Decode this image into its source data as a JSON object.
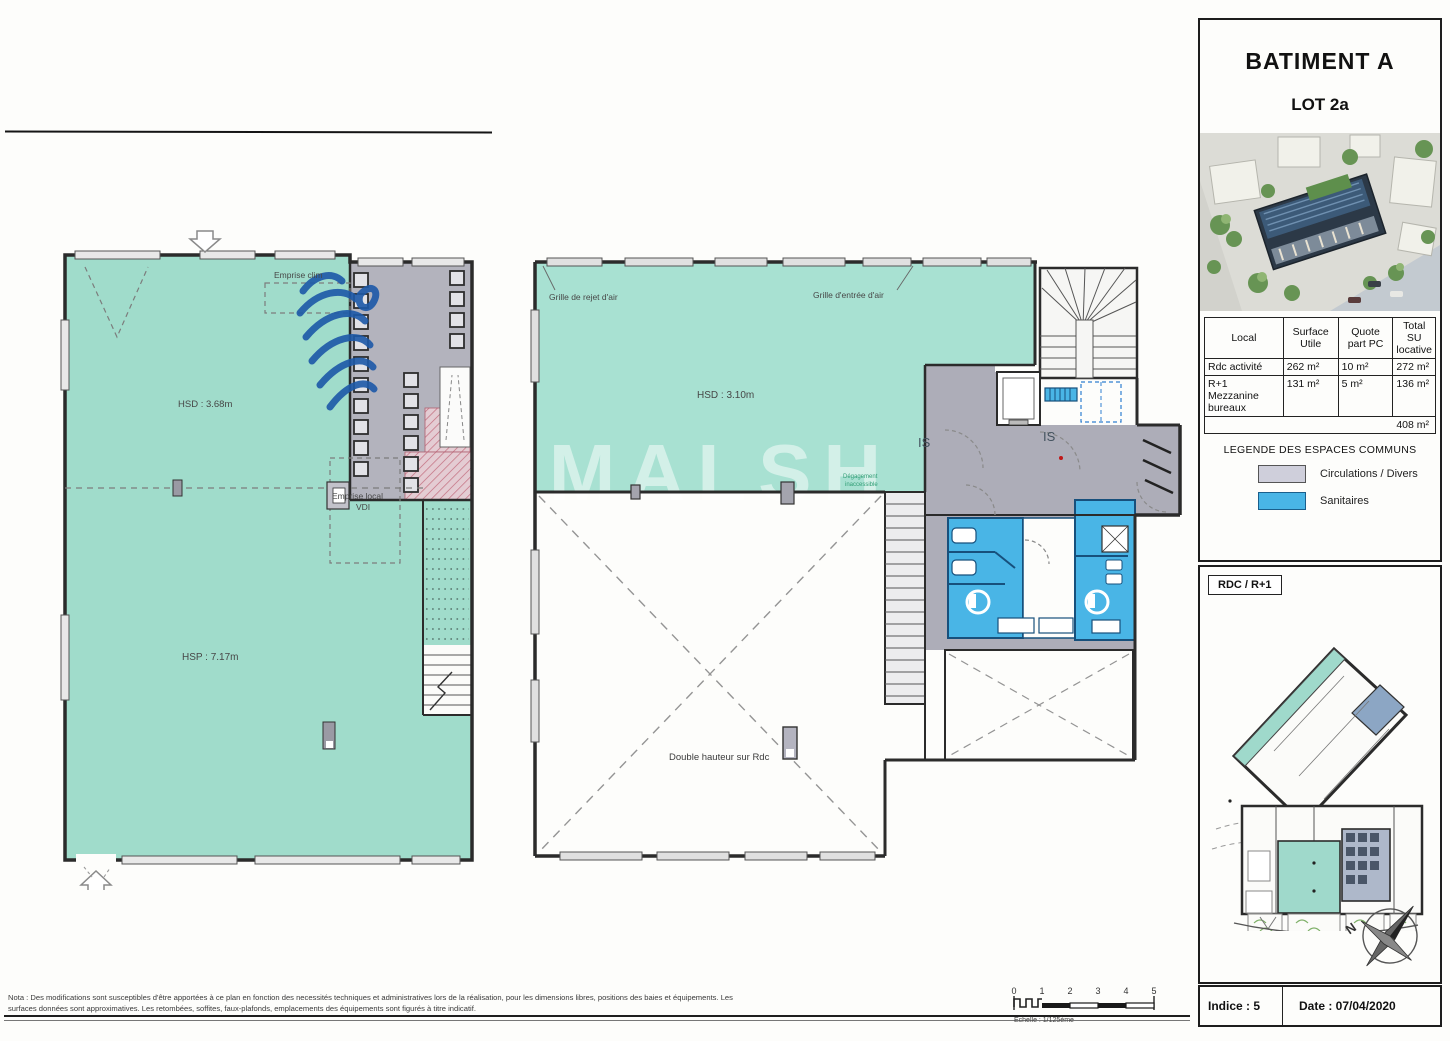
{
  "sidebar": {
    "title": "BATIMENT A",
    "lot": "LOT 2a",
    "table": {
      "headers": [
        "Local",
        "Surface Utile",
        "Quote part PC",
        "Total SU locative"
      ],
      "rows": [
        [
          "Rdc activité",
          "262 m²",
          "10 m²",
          "272 m²"
        ],
        [
          "R+1 Mezzanine bureaux",
          "131 m²",
          "5 m²",
          "136 m²"
        ]
      ],
      "total": "408 m²"
    },
    "legend": {
      "title": "LEGENDE DES ESPACES COMMUNS",
      "items": [
        {
          "label": "Circulations / Divers",
          "color": "#cfcfdb"
        },
        {
          "label": "Sanitaires",
          "color": "#49b5e6"
        }
      ]
    },
    "siteplan_label": "RDC / R+1",
    "compass_n": "N",
    "footer": {
      "indice": "Indice : 5",
      "date": "Date : 07/04/2020"
    }
  },
  "plans": {
    "left": {
      "emprise_clim": "Emprise clim",
      "hsd": "HSD : 3.68m",
      "emprise_vdi_1": "Emprise local",
      "emprise_vdi_2": "VDI",
      "hsp": "HSP : 7.17m"
    },
    "right": {
      "grille_rejet": "Grille de rejet d'air",
      "grille_entree": "Grille d'entrée d'air",
      "hsd": "HSD : 3.10m",
      "is_left": "IS",
      "is_right": "IS",
      "degagement_1": "Dégagement",
      "degagement_2": "inaccessible",
      "double_hauteur": "Double hauteur sur Rdc",
      "watermark": "MALSH"
    }
  },
  "note": "Nota : Des modifications sont susceptibles d'être apportées à ce plan en fonction des necessités techniques et administratives lors de la réalisation, pour les dimensions libres, positions des baies et équipements. Les surfaces données sont approximatives. Les retombées, soffites, faux-plafonds, emplacements des équipements sont figurés à titre indicatif.",
  "scalebar": {
    "ticks": [
      "0",
      "1",
      "2",
      "3",
      "4",
      "5"
    ],
    "caption": "Echelle : 1/125ème"
  },
  "colors": {
    "espace_lot": "#a6e0d0",
    "circulations": "#adadb8",
    "sanitaires": "#49b5e6",
    "wall": "#2b2b2b"
  }
}
